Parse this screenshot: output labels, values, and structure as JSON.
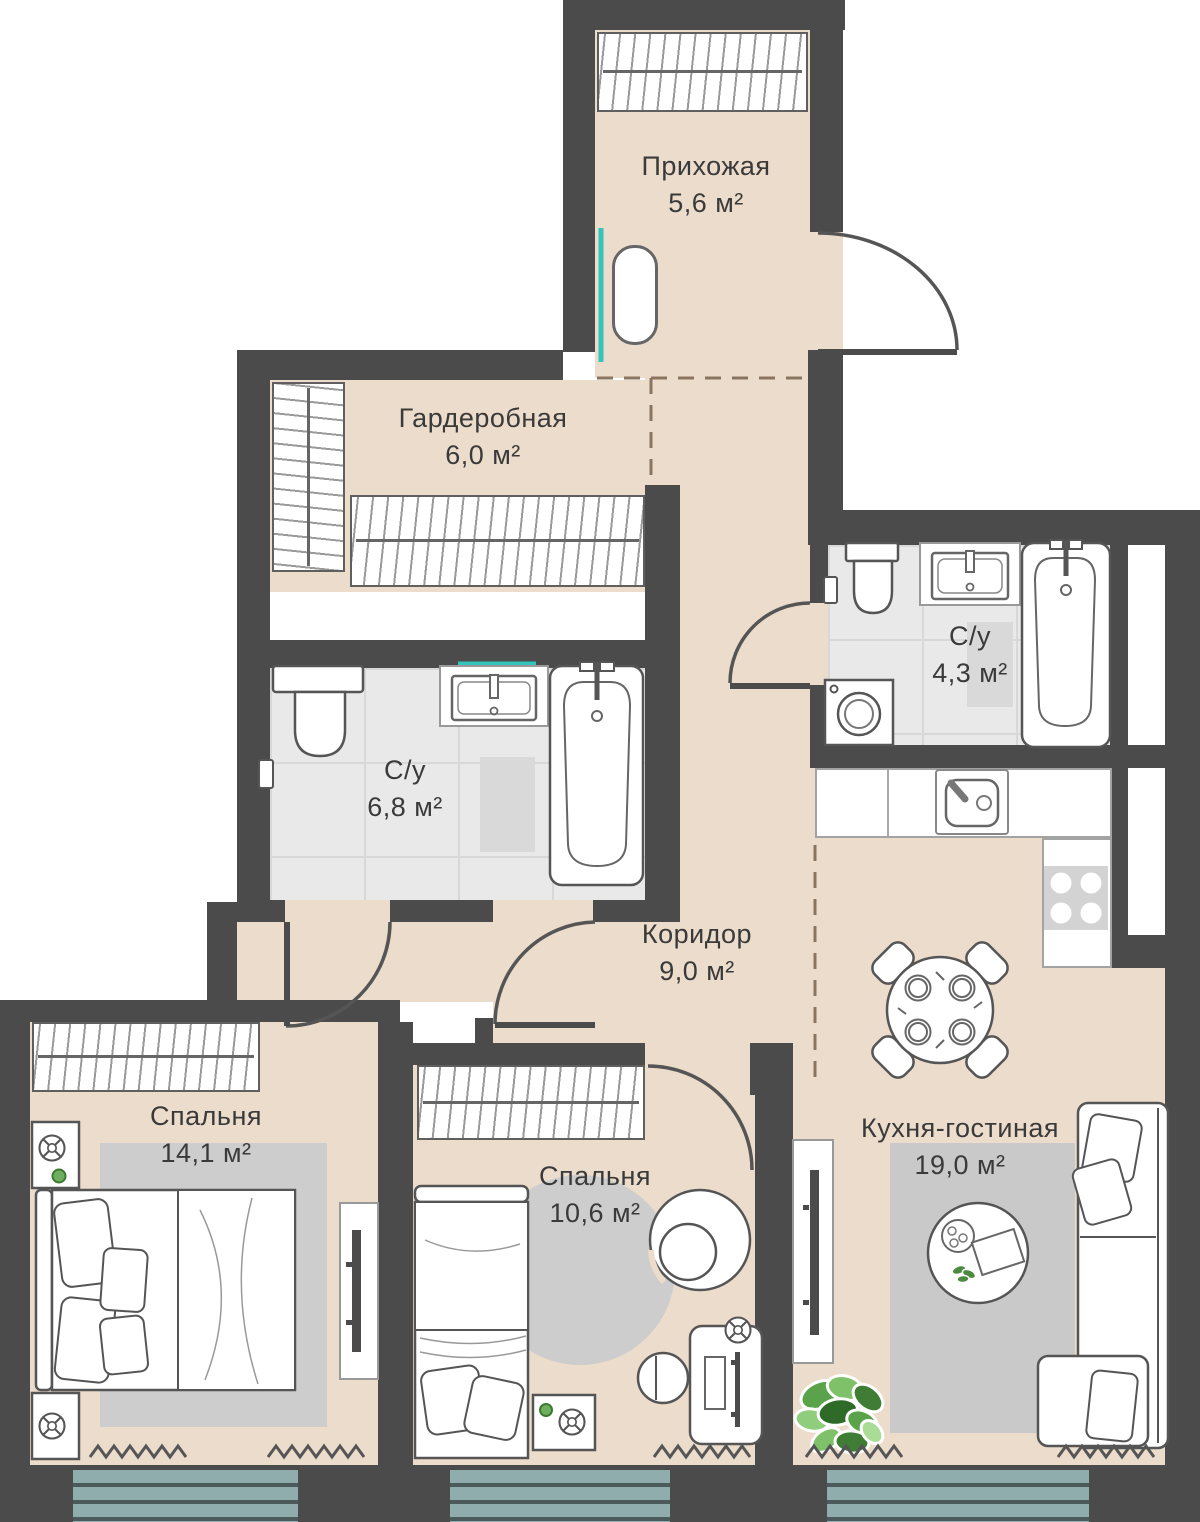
{
  "plan": {
    "title": "floor-plan",
    "rooms": [
      {
        "name": "Прихожая",
        "area": "5,6 м²"
      },
      {
        "name": "Гардеробная",
        "area": "6,0 м²"
      },
      {
        "name": "С/у",
        "area": "6,8 м²"
      },
      {
        "name": "С/у",
        "area": "4,3 м²"
      },
      {
        "name": "Коридор",
        "area": "9,0 м²"
      },
      {
        "name": "Спальня",
        "area": "14,1 м²"
      },
      {
        "name": "Спальня",
        "area": "10,6 м²"
      },
      {
        "name": "Кухня-гостиная",
        "area": "19,0 м²"
      }
    ],
    "colors": {
      "wall": "#4b4b4b",
      "floor": "#ecdccb",
      "bathroom_tile": "#e9e9e9",
      "mirror_accent": "#35c4bb",
      "balcony_glazing": "#8fadac",
      "rug": "#cdcdcd",
      "plant_green": "#5aa34a"
    }
  }
}
